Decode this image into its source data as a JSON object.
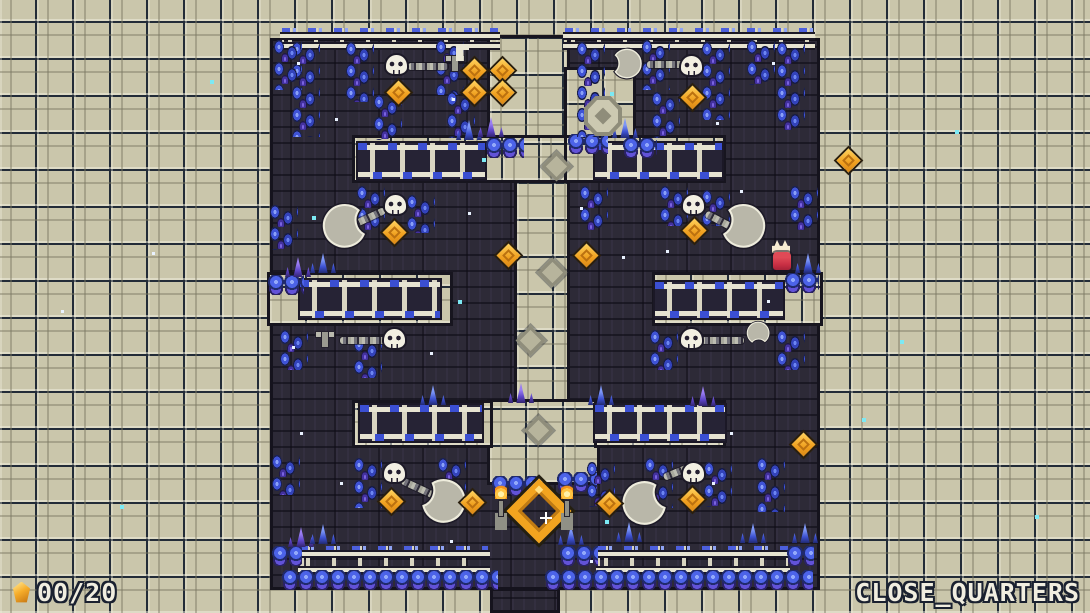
{
  "hud": {
    "counter": "00/20",
    "level_name": "CLOSE_QUARTERS"
  },
  "palette": {
    "bg_tan": "#cac6ab",
    "bg_dark": "#2d2a37",
    "crystal_blue": "#3c50cf",
    "crystal_purple": "#5b43c4",
    "coin_orange": "#f2a41f",
    "blade_gray": "#b9b7a9",
    "bone_white": "#f2efe2",
    "hud_text": "#f1eee0",
    "spark_cyan": "#7ce9f4"
  },
  "scene": {
    "width": 1090,
    "height": 613,
    "dark_rects": [
      {
        "x": 270,
        "y": 38,
        "w": 550,
        "h": 552
      },
      {
        "x": 490,
        "y": 588,
        "w": 70,
        "h": 25
      }
    ],
    "tan_rects": [
      {
        "x": 490,
        "y": 38,
        "w": 77,
        "h": 110
      },
      {
        "x": 567,
        "y": 70,
        "w": 66,
        "h": 70
      },
      {
        "x": 517,
        "y": 148,
        "w": 50,
        "h": 256
      },
      {
        "x": 490,
        "y": 402,
        "w": 107,
        "h": 80
      },
      {
        "x": 355,
        "y": 138,
        "w": 212,
        "h": 42
      },
      {
        "x": 567,
        "y": 138,
        "w": 156,
        "h": 42
      },
      {
        "x": 270,
        "y": 275,
        "w": 180,
        "h": 48
      },
      {
        "x": 655,
        "y": 275,
        "w": 165,
        "h": 48
      },
      {
        "x": 355,
        "y": 403,
        "w": 135,
        "h": 42
      },
      {
        "x": 597,
        "y": 403,
        "w": 126,
        "h": 42
      }
    ],
    "entities": [
      {
        "t": "rail",
        "x": 282,
        "y": 28,
        "w": 216,
        "h": 20
      },
      {
        "t": "rail",
        "x": 565,
        "y": 28,
        "w": 248,
        "h": 20
      },
      {
        "t": "rail",
        "x": 300,
        "y": 546,
        "w": 188,
        "h": 26
      },
      {
        "t": "rail",
        "x": 598,
        "y": 546,
        "w": 190,
        "h": 26
      },
      {
        "t": "ladder",
        "x": 358,
        "y": 143,
        "w": 127,
        "h": 36
      },
      {
        "t": "ladder",
        "x": 595,
        "y": 143,
        "w": 127,
        "h": 36
      },
      {
        "t": "ladder",
        "x": 300,
        "y": 280,
        "w": 140,
        "h": 38
      },
      {
        "t": "ladder",
        "x": 655,
        "y": 282,
        "w": 128,
        "h": 36
      },
      {
        "t": "ladder",
        "x": 360,
        "y": 405,
        "w": 122,
        "h": 36
      },
      {
        "t": "ladder",
        "x": 595,
        "y": 405,
        "w": 130,
        "h": 36
      },
      {
        "t": "orbs",
        "x": 282,
        "y": 570,
        "w": 216
      },
      {
        "t": "orbs",
        "x": 545,
        "y": 570,
        "w": 268
      },
      {
        "t": "orbs",
        "x": 272,
        "y": 546,
        "w": 30
      },
      {
        "t": "orbs",
        "x": 560,
        "y": 546,
        "w": 38
      },
      {
        "t": "orbs",
        "x": 787,
        "y": 546,
        "w": 27
      },
      {
        "t": "orbs",
        "x": 486,
        "y": 138,
        "w": 38
      },
      {
        "t": "orbs",
        "x": 623,
        "y": 138,
        "w": 34
      },
      {
        "t": "orbs",
        "x": 568,
        "y": 134,
        "w": 40
      },
      {
        "t": "orbs",
        "x": 492,
        "y": 476,
        "w": 46
      },
      {
        "t": "orbs",
        "x": 557,
        "y": 472,
        "w": 40
      },
      {
        "t": "orbs",
        "x": 268,
        "y": 275,
        "w": 36
      },
      {
        "t": "orbs",
        "x": 785,
        "y": 273,
        "w": 34
      },
      {
        "t": "vine",
        "x": 290,
        "y": 42,
        "h": 95
      },
      {
        "t": "vine",
        "x": 344,
        "y": 42,
        "h": 60
      },
      {
        "t": "vine",
        "x": 372,
        "y": 95,
        "h": 45
      },
      {
        "t": "vine",
        "x": 434,
        "y": 40,
        "h": 55
      },
      {
        "t": "vine",
        "x": 445,
        "y": 92,
        "h": 46
      },
      {
        "t": "vine",
        "x": 272,
        "y": 40,
        "h": 50
      },
      {
        "t": "vine",
        "x": 575,
        "y": 42,
        "h": 95
      },
      {
        "t": "vine",
        "x": 640,
        "y": 40,
        "h": 50
      },
      {
        "t": "vine",
        "x": 650,
        "y": 92,
        "h": 46
      },
      {
        "t": "vine",
        "x": 700,
        "y": 42,
        "h": 78
      },
      {
        "t": "vine",
        "x": 745,
        "y": 40,
        "h": 45
      },
      {
        "t": "vine",
        "x": 775,
        "y": 42,
        "h": 88
      },
      {
        "t": "vine",
        "x": 355,
        "y": 186,
        "h": 48
      },
      {
        "t": "vine",
        "x": 405,
        "y": 195,
        "h": 38
      },
      {
        "t": "vine",
        "x": 268,
        "y": 205,
        "h": 45
      },
      {
        "t": "vine",
        "x": 578,
        "y": 186,
        "h": 44
      },
      {
        "t": "vine",
        "x": 658,
        "y": 186,
        "h": 40
      },
      {
        "t": "vine",
        "x": 700,
        "y": 190,
        "h": 36
      },
      {
        "t": "vine",
        "x": 788,
        "y": 186,
        "h": 44
      },
      {
        "t": "vine",
        "x": 278,
        "y": 330,
        "h": 40
      },
      {
        "t": "vine",
        "x": 352,
        "y": 338,
        "h": 40
      },
      {
        "t": "vine",
        "x": 648,
        "y": 330,
        "h": 40
      },
      {
        "t": "vine",
        "x": 775,
        "y": 330,
        "h": 40
      },
      {
        "t": "vine",
        "x": 352,
        "y": 458,
        "h": 50
      },
      {
        "t": "vine",
        "x": 436,
        "y": 458,
        "h": 50
      },
      {
        "t": "vine",
        "x": 270,
        "y": 455,
        "h": 40
      },
      {
        "t": "vine",
        "x": 585,
        "y": 462,
        "h": 45
      },
      {
        "t": "vine",
        "x": 643,
        "y": 458,
        "h": 50
      },
      {
        "t": "vine",
        "x": 702,
        "y": 462,
        "h": 45
      },
      {
        "t": "vine",
        "x": 755,
        "y": 458,
        "h": 54
      },
      {
        "t": "tuft",
        "x": 285,
        "y": 257,
        "v": "purple"
      },
      {
        "t": "tuft",
        "x": 310,
        "y": 253
      },
      {
        "t": "tuft",
        "x": 456,
        "y": 120
      },
      {
        "t": "tuft",
        "x": 478,
        "y": 117,
        "v": "purple"
      },
      {
        "t": "tuft",
        "x": 612,
        "y": 118
      },
      {
        "t": "tuft",
        "x": 795,
        "y": 253
      },
      {
        "t": "tuft",
        "x": 420,
        "y": 385
      },
      {
        "t": "tuft",
        "x": 508,
        "y": 383,
        "v": "purple"
      },
      {
        "t": "tuft",
        "x": 588,
        "y": 385
      },
      {
        "t": "tuft",
        "x": 690,
        "y": 386,
        "v": "purple"
      },
      {
        "t": "tuft",
        "x": 288,
        "y": 527,
        "v": "purple"
      },
      {
        "t": "tuft",
        "x": 310,
        "y": 524
      },
      {
        "t": "tuft",
        "x": 558,
        "y": 525
      },
      {
        "t": "tuft",
        "x": 616,
        "y": 522
      },
      {
        "t": "tuft",
        "x": 740,
        "y": 523
      },
      {
        "t": "tuft",
        "x": 792,
        "y": 523
      },
      {
        "t": "medal",
        "x": 584,
        "y": 96
      },
      {
        "t": "orn",
        "x": 546,
        "y": 156
      },
      {
        "t": "orn",
        "x": 542,
        "y": 262
      },
      {
        "t": "orn",
        "x": 520,
        "y": 330
      },
      {
        "t": "orn",
        "x": 528,
        "y": 420
      },
      {
        "t": "mount",
        "x": 446,
        "y": 52
      },
      {
        "t": "bracket",
        "x": 456,
        "y": 44
      },
      {
        "t": "mount",
        "x": 316,
        "y": 328
      },
      {
        "t": "chain",
        "x": 352,
        "y": 222,
        "w": 36,
        "rot": -25
      },
      {
        "t": "chain",
        "x": 408,
        "y": 63,
        "w": 40
      },
      {
        "t": "chain",
        "x": 647,
        "y": 61,
        "w": 38
      },
      {
        "t": "chain",
        "x": 706,
        "y": 210,
        "w": 36,
        "rot": 28
      },
      {
        "t": "chain",
        "x": 340,
        "y": 337,
        "w": 46
      },
      {
        "t": "chain",
        "x": 702,
        "y": 337,
        "w": 42
      },
      {
        "t": "chain",
        "x": 402,
        "y": 477,
        "w": 38,
        "rot": 25
      },
      {
        "t": "chain",
        "x": 664,
        "y": 474,
        "w": 36,
        "rot": -22
      },
      {
        "t": "moon",
        "x": 320,
        "y": 203
      },
      {
        "t": "moon",
        "x": 718,
        "y": 203,
        "flip": 1
      },
      {
        "t": "moon",
        "x": 418,
        "y": 478,
        "flip": 1,
        "rot": 10
      },
      {
        "t": "moon",
        "x": 620,
        "y": 480,
        "rot": -10
      },
      {
        "t": "blade",
        "x": 606,
        "y": 48,
        "w": 42,
        "h": 34,
        "flip": 1,
        "rot": -12
      },
      {
        "t": "blade",
        "x": 742,
        "y": 320,
        "w": 30,
        "h": 26,
        "rot": 100
      },
      {
        "t": "skull",
        "x": 386,
        "y": 55
      },
      {
        "t": "skull",
        "x": 681,
        "y": 56
      },
      {
        "t": "skull",
        "x": 385,
        "y": 195
      },
      {
        "t": "skull",
        "x": 683,
        "y": 195
      },
      {
        "t": "skull",
        "x": 384,
        "y": 329
      },
      {
        "t": "skull",
        "x": 681,
        "y": 329
      },
      {
        "t": "skull",
        "x": 384,
        "y": 463
      },
      {
        "t": "skull",
        "x": 683,
        "y": 463
      },
      {
        "t": "coin",
        "x": 390,
        "y": 84
      },
      {
        "t": "coin",
        "x": 466,
        "y": 62
      },
      {
        "t": "coin",
        "x": 494,
        "y": 62
      },
      {
        "t": "coin",
        "x": 466,
        "y": 84
      },
      {
        "t": "coin",
        "x": 494,
        "y": 84
      },
      {
        "t": "coin",
        "x": 684,
        "y": 89
      },
      {
        "t": "coin",
        "x": 386,
        "y": 224
      },
      {
        "t": "coin",
        "x": 686,
        "y": 222
      },
      {
        "t": "coin",
        "x": 500,
        "y": 247
      },
      {
        "t": "coin",
        "x": 578,
        "y": 247
      },
      {
        "t": "coin",
        "x": 840,
        "y": 152
      },
      {
        "t": "coin",
        "x": 795,
        "y": 436
      },
      {
        "t": "coin",
        "x": 383,
        "y": 493
      },
      {
        "t": "coin",
        "x": 464,
        "y": 494
      },
      {
        "t": "coin",
        "x": 601,
        "y": 495
      },
      {
        "t": "coin",
        "x": 684,
        "y": 491
      },
      {
        "t": "ring",
        "x": 516,
        "y": 488
      },
      {
        "t": "torch",
        "x": 494,
        "y": 484
      },
      {
        "t": "torch",
        "x": 560,
        "y": 484
      },
      {
        "t": "plus",
        "x": 540,
        "y": 512
      },
      {
        "t": "char",
        "x": 771,
        "y": 238
      },
      {
        "t": "star",
        "x": 297,
        "y": 62
      },
      {
        "t": "star",
        "x": 452,
        "y": 98
      },
      {
        "t": "star",
        "x": 610,
        "y": 92,
        "v": "c"
      },
      {
        "t": "star",
        "x": 335,
        "y": 118
      },
      {
        "t": "star",
        "x": 772,
        "y": 62
      },
      {
        "t": "star",
        "x": 716,
        "y": 122
      },
      {
        "t": "star",
        "x": 580,
        "y": 207
      },
      {
        "t": "star",
        "x": 468,
        "y": 212
      },
      {
        "t": "star",
        "x": 740,
        "y": 190
      },
      {
        "t": "star",
        "x": 312,
        "y": 216,
        "v": "c"
      },
      {
        "t": "star",
        "x": 622,
        "y": 256
      },
      {
        "t": "star",
        "x": 666,
        "y": 250
      },
      {
        "t": "star",
        "x": 458,
        "y": 300,
        "v": "c"
      },
      {
        "t": "star",
        "x": 767,
        "y": 300
      },
      {
        "t": "star",
        "x": 292,
        "y": 346
      },
      {
        "t": "star",
        "x": 300,
        "y": 432
      },
      {
        "t": "star",
        "x": 730,
        "y": 432
      },
      {
        "t": "star",
        "x": 340,
        "y": 482
      },
      {
        "t": "star",
        "x": 712,
        "y": 482
      },
      {
        "t": "star",
        "x": 605,
        "y": 520,
        "v": "c"
      },
      {
        "t": "star",
        "x": 450,
        "y": 540
      },
      {
        "t": "star",
        "x": 482,
        "y": 158,
        "v": "c"
      },
      {
        "t": "star",
        "x": 590,
        "y": 560
      },
      {
        "t": "star",
        "x": 430,
        "y": 352
      },
      {
        "t": "star",
        "x": 152,
        "y": 252
      },
      {
        "t": "star",
        "x": 61,
        "y": 310
      },
      {
        "t": "star",
        "x": 862,
        "y": 418,
        "v": "c"
      },
      {
        "t": "star",
        "x": 955,
        "y": 130,
        "v": "c"
      },
      {
        "t": "star",
        "x": 1035,
        "y": 515,
        "v": "c"
      },
      {
        "t": "star",
        "x": 120,
        "y": 505,
        "v": "c"
      },
      {
        "t": "star",
        "x": 210,
        "y": 80,
        "v": "c"
      },
      {
        "t": "star",
        "x": 900,
        "y": 340,
        "v": "c"
      }
    ]
  }
}
